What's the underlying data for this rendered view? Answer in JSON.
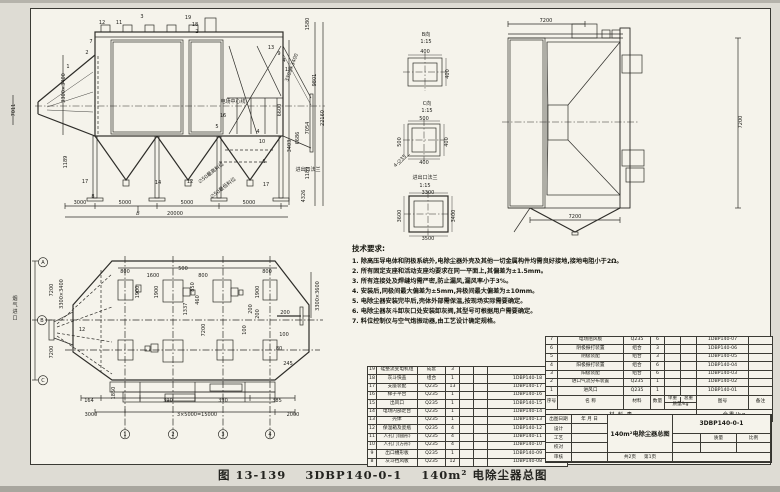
{
  "caption": {
    "fig_no": "图 13-139",
    "drawing_no": "3DBP140-0-1",
    "title": "140m² 电除尘器总图"
  },
  "tech_requirements": {
    "title": "技术要求:",
    "items": [
      "1. 除高压导电体和阴极系统外,电除尘器外壳及其他一切金属构件均需良好接地,接地电阻小于2Ω。",
      "2. 所有固定支座和活动支座均要求在同一平面上,其偏差为±1.5mm。",
      "3. 所有连接处及焊缝均需严密,防止漏风,漏风率小于3%。",
      "4. 安装后,同极间最大偏差为±5mm,异极间最大偏差为±10mm。",
      "5. 电除尘器安装完毕后,壳体外部需保温,按现场实际需要确定。",
      "6. 电除尘器灰斗卸灰口处安装卸灰阀,其型号可根据用户需要确定。",
      "7. 料位控制仪与空气炮振动器,由工艺设计确定规格。"
    ]
  },
  "parts_table_left": {
    "rows": [
      {
        "no": "19",
        "name": "硅整流变电机组",
        "material": "成套",
        "qty": "3",
        "unit": "",
        "total": "",
        "dwg": ""
      },
      {
        "no": "18",
        "name": "灰斗快盖",
        "material": "组合",
        "qty": "1",
        "unit": "",
        "total": "",
        "dwg": "1DBP140-18"
      },
      {
        "no": "17",
        "name": "支座装配",
        "material": "Q235",
        "qty": "13",
        "unit": "",
        "total": "",
        "dwg": "1DBP140-17"
      },
      {
        "no": "16",
        "name": "梯子平台",
        "material": "Q235",
        "qty": "1",
        "unit": "",
        "total": "",
        "dwg": "1DBP140-16"
      },
      {
        "no": "15",
        "name": "出风口",
        "material": "Q235",
        "qty": "1",
        "unit": "",
        "total": "",
        "dwg": "1DBP140-15"
      },
      {
        "no": "14",
        "name": "电场内部走台",
        "material": "Q235",
        "qty": "1",
        "unit": "",
        "total": "",
        "dwg": "1DBP140-14"
      },
      {
        "no": "13",
        "name": "壳体",
        "material": "Q235",
        "qty": "1",
        "unit": "",
        "total": "",
        "dwg": "1DBP140-13"
      },
      {
        "no": "12",
        "name": "保温箱及瓷瓶",
        "material": "Q235",
        "qty": "4",
        "unit": "",
        "total": "",
        "dwg": "1DBP140-12"
      },
      {
        "no": "11",
        "name": "人孔门(圆形)",
        "material": "Q235",
        "qty": "4",
        "unit": "",
        "total": "",
        "dwg": "1DBP140-11"
      },
      {
        "no": "10",
        "name": "人孔门(方形)",
        "material": "Q235",
        "qty": "4",
        "unit": "",
        "total": "",
        "dwg": "1DBP140-10"
      },
      {
        "no": "9",
        "name": "出口槽形板",
        "material": "Q235",
        "qty": "1",
        "unit": "",
        "total": "",
        "dwg": "1DBP140-09"
      },
      {
        "no": "8",
        "name": "灰斗挡风板",
        "material": "Q235",
        "qty": "12",
        "unit": "",
        "total": "",
        "dwg": "1DBP140-08"
      }
    ]
  },
  "parts_table_right": {
    "rows": [
      {
        "no": "7",
        "name": "电场阻风板",
        "material": "Q235",
        "qty": "6",
        "unit": "",
        "total": "",
        "dwg": "1DBP140-07",
        "rem": ""
      },
      {
        "no": "6",
        "name": "阴极振打装置",
        "material": "组合",
        "qty": "3",
        "unit": "",
        "total": "",
        "dwg": "1DBP140-06",
        "rem": ""
      },
      {
        "no": "5",
        "name": "阴极装配",
        "material": "组合",
        "qty": "3",
        "unit": "",
        "total": "",
        "dwg": "1DBP140-05",
        "rem": ""
      },
      {
        "no": "4",
        "name": "阳极振打装置",
        "material": "组合",
        "qty": "6",
        "unit": "",
        "total": "",
        "dwg": "1DBP140-04",
        "rem": ""
      },
      {
        "no": "3",
        "name": "阳极装配",
        "material": "组合",
        "qty": "6",
        "unit": "",
        "total": "",
        "dwg": "1DBP140-03",
        "rem": ""
      },
      {
        "no": "2",
        "name": "进口气流分布装置",
        "material": "Q235",
        "qty": "1",
        "unit": "",
        "total": "",
        "dwg": "1DBP140-02",
        "rem": ""
      },
      {
        "no": "1",
        "name": "进风口",
        "material": "Q235",
        "qty": "1",
        "unit": "",
        "total": "",
        "dwg": "1DBP140-01",
        "rem": ""
      }
    ],
    "header": {
      "seq": "序号",
      "name": "名  称",
      "material": "材料",
      "qty": "数量",
      "unit_weight": "单重",
      "total_weight": "总重",
      "weight_unit": "质量/kg",
      "dwg_no": "图号",
      "remark": "备注"
    },
    "footer": {
      "label": "材 料 表",
      "total": "全重/kg"
    }
  },
  "title_block": {
    "date_label": "出图日期",
    "date_value": "年 月 日",
    "row_labels": [
      "设计",
      "工艺",
      "校对",
      "审核"
    ],
    "title": "140m²电除尘器总图",
    "dwg_no": "3DBP140-0-1",
    "mass_label": "质量",
    "scale_label": "比例",
    "pages_total": "共2页",
    "page_no": "第1页"
  },
  "views": {
    "front": {
      "labels": [
        {
          "t": "12",
          "x": 97,
          "y": 14
        },
        {
          "t": "11",
          "x": 114,
          "y": 14
        },
        {
          "t": "3",
          "x": 137,
          "y": 8
        },
        {
          "t": "19",
          "x": 183,
          "y": 9
        },
        {
          "t": "18",
          "x": 190,
          "y": 16
        },
        {
          "t": "2",
          "x": 192,
          "y": 23
        },
        {
          "t": "7",
          "x": 86,
          "y": 33
        },
        {
          "t": "2",
          "x": 82,
          "y": 44
        },
        {
          "t": "1",
          "x": 63,
          "y": 58
        },
        {
          "t": "13",
          "x": 266,
          "y": 39
        },
        {
          "t": "9",
          "x": 274,
          "y": 45
        },
        {
          "t": "4",
          "x": 279,
          "y": 52
        },
        {
          "t": "15",
          "x": 283,
          "y": 61
        },
        {
          "t": "4",
          "x": 253,
          "y": 123
        },
        {
          "t": "10",
          "x": 257,
          "y": 133
        },
        {
          "t": "6",
          "x": 259,
          "y": 153
        },
        {
          "t": "17",
          "x": 261,
          "y": 176
        },
        {
          "t": "16",
          "x": 218,
          "y": 107
        },
        {
          "t": "5",
          "x": 212,
          "y": 118
        },
        {
          "t": "17",
          "x": 80,
          "y": 173
        },
        {
          "t": "8",
          "x": 88,
          "y": 188
        },
        {
          "t": "14",
          "x": 153,
          "y": 174
        },
        {
          "t": "12",
          "x": 185,
          "y": 173
        },
        {
          "t": "B",
          "x": 133,
          "y": 205,
          "i": 1,
          "s": 6
        },
        {
          "t": "3000",
          "x": 75,
          "y": 194
        },
        {
          "t": "5000",
          "x": 120,
          "y": 194
        },
        {
          "t": "5000",
          "x": 182,
          "y": 194
        },
        {
          "t": "5000",
          "x": 244,
          "y": 194
        },
        {
          "t": "20000",
          "x": 170,
          "y": 205
        },
        {
          "t": "3300×3400",
          "x": 60,
          "y": 78,
          "r": -90
        },
        {
          "t": "7011",
          "x": 10,
          "y": 100,
          "r": -90
        },
        {
          "t": "1189",
          "x": 62,
          "y": 152,
          "r": -90
        },
        {
          "t": "6600",
          "x": 276,
          "y": 100,
          "r": -90
        },
        {
          "t": "3403",
          "x": 286,
          "y": 136,
          "r": -90
        },
        {
          "t": "6686",
          "x": 294,
          "y": 128,
          "r": -90
        },
        {
          "t": "7054",
          "x": 304,
          "y": 118,
          "r": -90
        },
        {
          "t": "1189",
          "x": 304,
          "y": 163,
          "r": -90
        },
        {
          "t": "4326",
          "x": 300,
          "y": 186,
          "r": -90
        },
        {
          "t": "1580",
          "x": 304,
          "y": 14,
          "r": -90
        },
        {
          "t": "9801",
          "x": 311,
          "y": 70,
          "r": -90
        },
        {
          "t": "22160",
          "x": 319,
          "y": 108,
          "r": -90
        },
        {
          "t": "3300×3400",
          "x": 288,
          "y": 58,
          "r": -70
        },
        {
          "t": "电场中心线",
          "x": 228,
          "y": 93,
          "s": 7
        },
        {
          "t": "∅50最高料位",
          "x": 207,
          "y": 164,
          "r": -38,
          "s": 5.5
        },
        {
          "t": "∅50最低料位",
          "x": 219,
          "y": 179,
          "r": -38,
          "s": 5.5
        },
        {
          "t": "进出口法兰",
          "x": 303,
          "y": 161,
          "s": 5.5
        }
      ]
    },
    "details": {
      "labels": [
        {
          "t": "B向",
          "x": 33,
          "y": 8,
          "s": 6
        },
        {
          "t": "1:15",
          "x": 33,
          "y": 15
        },
        {
          "t": "400",
          "x": 32,
          "y": 25
        },
        {
          "t": "400",
          "x": 56,
          "y": 46,
          "r": -90
        },
        {
          "t": "C向",
          "x": 34,
          "y": 77,
          "s": 6
        },
        {
          "t": "1:15",
          "x": 34,
          "y": 84
        },
        {
          "t": "500",
          "x": 31,
          "y": 92
        },
        {
          "t": "500",
          "x": 8,
          "y": 114,
          "r": -90
        },
        {
          "t": "400",
          "x": 55,
          "y": 114,
          "r": -90
        },
        {
          "t": "400",
          "x": 31,
          "y": 136
        },
        {
          "t": "4-∅35",
          "x": 8,
          "y": 134,
          "r": -45
        },
        {
          "t": "进出口法兰",
          "x": 32,
          "y": 151,
          "s": 6.5
        },
        {
          "t": "1:15",
          "x": 32,
          "y": 159
        },
        {
          "t": "3300",
          "x": 35,
          "y": 166
        },
        {
          "t": "3600",
          "x": 8,
          "y": 188,
          "r": -90
        },
        {
          "t": "3400",
          "x": 62,
          "y": 188,
          "r": -90
        },
        {
          "t": "3500",
          "x": 35,
          "y": 212
        }
      ]
    },
    "side": {
      "labels": [
        {
          "t": "7200",
          "x": 48,
          "y": 12
        },
        {
          "t": "7200",
          "x": 77,
          "y": 208
        },
        {
          "t": "7200",
          "x": 244,
          "y": 112,
          "r": -90
        }
      ]
    },
    "plan": {
      "labels": [
        {
          "t": "800",
          "x": 120,
          "y": 21
        },
        {
          "t": "1600",
          "x": 148,
          "y": 25
        },
        {
          "t": "500",
          "x": 178,
          "y": 18
        },
        {
          "t": "800",
          "x": 198,
          "y": 25
        },
        {
          "t": "800",
          "x": 262,
          "y": 21
        },
        {
          "t": "1900",
          "x": 134,
          "y": 40,
          "r": -90
        },
        {
          "t": "1900",
          "x": 153,
          "y": 40,
          "r": -90
        },
        {
          "t": "1900",
          "x": 254,
          "y": 40,
          "r": -90
        },
        {
          "t": "850",
          "x": 189,
          "y": 35,
          "r": -90
        },
        {
          "t": "460",
          "x": 194,
          "y": 48,
          "r": -90
        },
        {
          "t": "1337",
          "x": 182,
          "y": 57,
          "r": -90
        },
        {
          "t": "7200",
          "x": 200,
          "y": 78,
          "r": -90
        },
        {
          "t": "200",
          "x": 247,
          "y": 57,
          "r": -90
        },
        {
          "t": "200",
          "x": 254,
          "y": 62,
          "r": -90
        },
        {
          "t": "200",
          "x": 280,
          "y": 62
        },
        {
          "t": "100",
          "x": 241,
          "y": 78,
          "r": -90
        },
        {
          "t": "100",
          "x": 279,
          "y": 84
        },
        {
          "t": "80",
          "x": 274,
          "y": 98
        },
        {
          "t": "245",
          "x": 283,
          "y": 113
        },
        {
          "t": "12",
          "x": 77,
          "y": 79
        },
        {
          "t": "7200",
          "x": 48,
          "y": 38,
          "r": -90
        },
        {
          "t": "7200",
          "x": 48,
          "y": 100,
          "r": -90
        },
        {
          "t": "3300×3400",
          "x": 58,
          "y": 42,
          "r": -90
        },
        {
          "t": "3300×3600",
          "x": 314,
          "y": 44,
          "r": -90
        },
        {
          "t": "164",
          "x": 84,
          "y": 150
        },
        {
          "t": "1850",
          "x": 110,
          "y": 141,
          "r": -90
        },
        {
          "t": "390",
          "x": 163,
          "y": 150
        },
        {
          "t": "390",
          "x": 218,
          "y": 150
        },
        {
          "t": "385",
          "x": 272,
          "y": 150
        },
        {
          "t": "3000",
          "x": 86,
          "y": 164
        },
        {
          "t": "3×5000=15000",
          "x": 192,
          "y": 164
        },
        {
          "t": "2000",
          "x": 288,
          "y": 164
        },
        {
          "t": "烟气进口",
          "x": 10,
          "y": 48,
          "v": 1,
          "s": 6
        },
        {
          "t": "A",
          "x": 38,
          "y": 12,
          "c": 1
        },
        {
          "t": "B",
          "x": 37,
          "y": 70,
          "c": 1
        },
        {
          "t": "C",
          "x": 38,
          "y": 130,
          "c": 1
        },
        {
          "t": "1",
          "x": 120,
          "y": 184,
          "c": 1
        },
        {
          "t": "2",
          "x": 168,
          "y": 184,
          "c": 1
        },
        {
          "t": "3",
          "x": 218,
          "y": 184,
          "c": 1
        },
        {
          "t": "4",
          "x": 265,
          "y": 184,
          "c": 1
        }
      ]
    }
  }
}
